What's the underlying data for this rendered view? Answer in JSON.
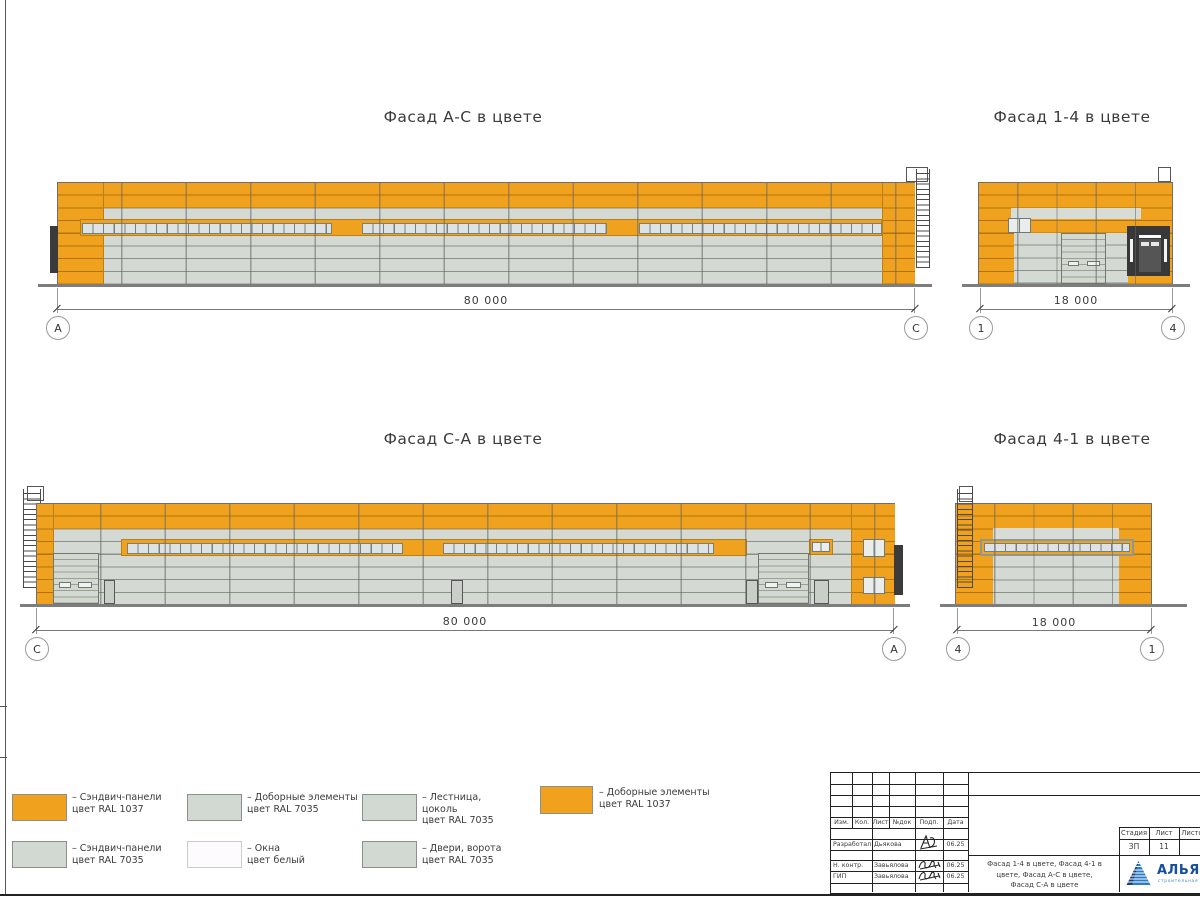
{
  "views": {
    "ac": {
      "title": "Фасад А-С в цвете",
      "dim": "80 000",
      "marker_left": "А",
      "marker_right": "С"
    },
    "f14": {
      "title": "Фасад 1-4 в цвете",
      "dim": "18 000",
      "marker_left": "1",
      "marker_right": "4"
    },
    "ca": {
      "title": "Фасад С-А в цвете",
      "dim": "80 000",
      "marker_left": "С",
      "marker_right": "А"
    },
    "f41": {
      "title": "Фасад 4-1 в цвете",
      "dim": "18 000",
      "marker_left": "4",
      "marker_right": "1"
    }
  },
  "colors": {
    "panel_orange": "#F0A11E",
    "panel_gray": "#D4D9D3",
    "window_white": "#FDFBFD",
    "dark_door": "#3B3B3B",
    "logo_blue": "#164F9E"
  },
  "legend": {
    "items": [
      {
        "color": "#F0A11E",
        "label": "– Сэндвич-панели\nцвет RAL 1037"
      },
      {
        "color": "#D2D8D2",
        "label": "– Сэндвич-панели\nцвет RAL 7035"
      },
      {
        "color": "#D2D8D2",
        "label": "– Доборные элементы\nцвет RAL 7035"
      },
      {
        "color": "#FDFBFD",
        "label": "– Окна\nцвет белый"
      },
      {
        "color": "#D2D8D2",
        "label": "– Лестница,\nцоколь\nцвет RAL 7035"
      },
      {
        "color": "#D2D8D2",
        "label": "– Двери, ворота\nцвет RAL 7035"
      },
      {
        "color": "#F0A11E",
        "label": "– Доборные элементы\nцвет RAL 1037"
      }
    ]
  },
  "title_block": {
    "headers": {
      "izm": "Изм.",
      "kol": "Кол.",
      "list": "Лист",
      "ndok": "№док",
      "podp": "Подп.",
      "data": "Дата"
    },
    "rows": [
      {
        "role": "Разработал",
        "name": "Дьякова",
        "date": "06.25"
      },
      {
        "role": "Н. контр.",
        "name": "Завьялова",
        "date": "06.25"
      },
      {
        "role": "ГИП",
        "name": "Завьялова",
        "date": "06.25"
      }
    ],
    "stage_label": "Стадия",
    "sheet_label": "Лист",
    "sheets_label": "Листов",
    "stage": "ЗП",
    "sheet": "11",
    "sheets": "1",
    "doc_title": "Фасад 1-4 в цвете, Фасад 4-1 в\nцвете, Фасад А-С в цвете,\nФасад С-А в цвете",
    "company": "АЛЬЯНС",
    "company_sub": "строительная компания"
  }
}
